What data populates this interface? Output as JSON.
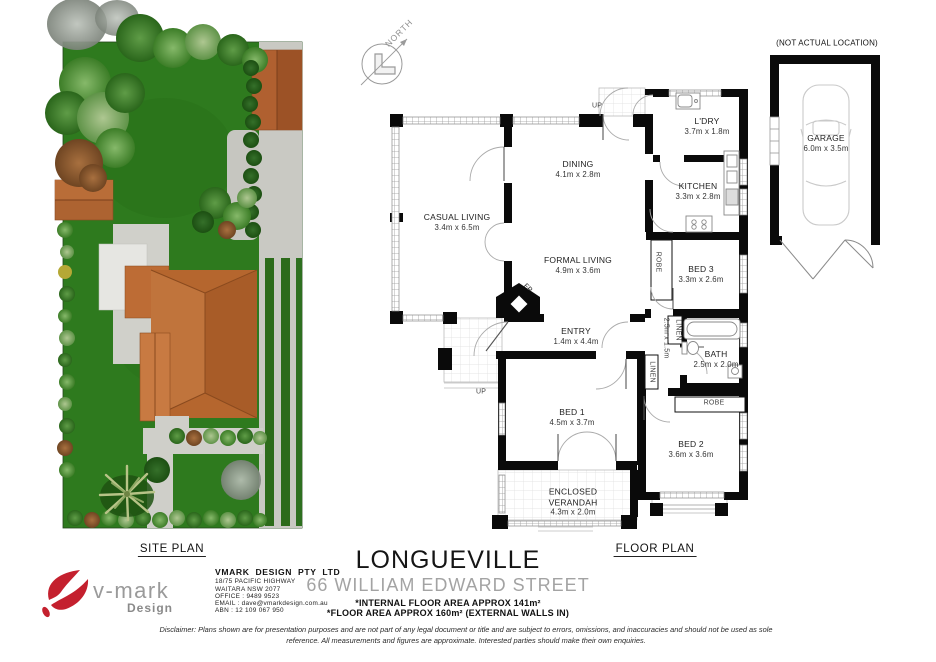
{
  "site_plan": {
    "label": "SITE PLAN"
  },
  "north": {
    "label": "NORTH"
  },
  "floor_plan": {
    "label": "FLOOR PLAN",
    "rooms": [
      {
        "name": "DINING",
        "dims": "4.1m x 2.8m"
      },
      {
        "name": "CASUAL LIVING",
        "dims": "3.4m x 6.5m"
      },
      {
        "name": "FORMAL LIVING",
        "dims": "4.9m x 3.6m"
      },
      {
        "name": "L'DRY",
        "dims": "3.7m x 1.8m"
      },
      {
        "name": "KITCHEN",
        "dims": "3.3m x 2.8m"
      },
      {
        "name": "BED 3",
        "dims": "3.3m x 2.6m"
      },
      {
        "name": "ENTRY",
        "dims": "1.4m x 4.4m"
      },
      {
        "name": "BATH",
        "dims": "2.5m x 2.0m"
      },
      {
        "name": "BED 1",
        "dims": "4.5m x 3.7m"
      },
      {
        "name": "BED 2",
        "dims": "3.6m x 3.6m"
      },
      {
        "name": "ENCLOSED VERANDAH",
        "dims": "4.3m x 2.0m"
      }
    ],
    "small_labels": {
      "robe_bed3": "ROBE",
      "robe_bed2": "ROBE",
      "linen_top": "LINEN",
      "linen_bottom": "LINEN",
      "hall_dims": "2.5m x 1.5m",
      "up_front": "UP",
      "up_back": "UP",
      "fp": "FP"
    }
  },
  "garage": {
    "note": "(NOT ACTUAL LOCATION)",
    "name": "GARAGE",
    "dims": "6.0m x 3.5m"
  },
  "title_block": {
    "suburb": "LONGUEVILLE",
    "address": "66 WILLIAM EDWARD STREET",
    "area_line1": "*INTERNAL FLOOR AREA APPROX 141m²",
    "area_line2": "*FLOOR AREA APPROX 160m² (EXTERNAL WALLS IN)"
  },
  "company": {
    "logo_text": "v-mark",
    "logo_sub": "Design",
    "name": "VMARK DESIGN PTY LTD",
    "address1": "18/75 PACIFIC HIGHWAY",
    "address2": "WAITARA NSW 2077",
    "office": "OFFICE : 9489 9523",
    "email": "EMAIL : dave@vmarkdesign.com.au",
    "abn": "ABN : 12 109 067 950"
  },
  "disclaimer": {
    "line1": "Disclaimer:  Plans shown are for presentation purposes and are not part of any legal document or title and are subject to errors, omissions, and inaccuracies and should not be used as sole",
    "line2": "reference. All measurements and figures are approximate. Interested parties should make their own enquiries."
  },
  "colors": {
    "accent_red": "#c4202e",
    "roof_terracotta": "#b5662e",
    "lawn_green": "#2e7a1e",
    "wall_black": "#0a0a0a",
    "muted_gray": "#9b9b9b"
  }
}
